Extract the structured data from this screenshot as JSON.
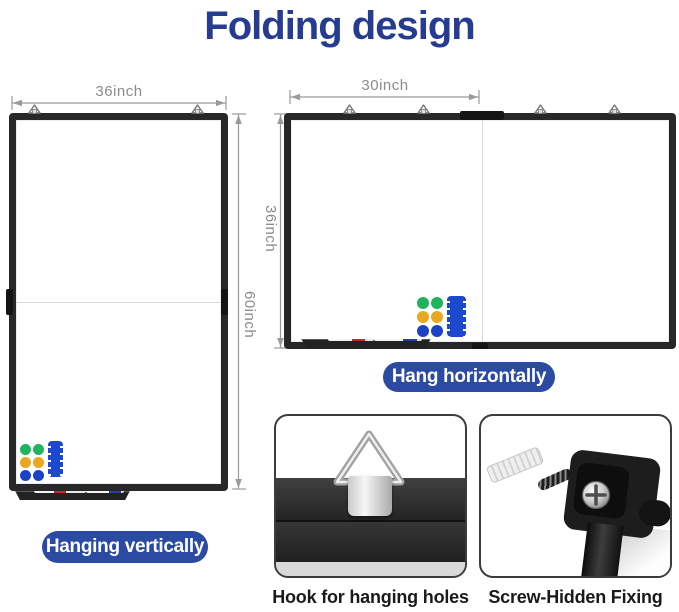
{
  "title": "Folding design",
  "boards": {
    "vertical": {
      "width_label": "36inch",
      "height_label": "60inch",
      "caption": "Hanging vertically"
    },
    "horizontal": {
      "width_label": "30inch",
      "height_label": "36inch",
      "caption": "Hang horizontally"
    }
  },
  "details": [
    {
      "caption": "Hook for hanging holes"
    },
    {
      "caption": "Screw-Hidden Fixing"
    }
  ],
  "icons": {
    "hanging_hook": "triangle-d-ring-hook",
    "magnets": "colored-dot-magnets",
    "eraser": "whiteboard-eraser",
    "markers": "marker-pens",
    "screw": "phillips-screw-head",
    "anchor": "wall-anchor-plug"
  },
  "colors": {
    "title": "#263c92",
    "pill_bg": "#2b4aa1",
    "pill_text": "#ffffff",
    "frame": "#282828",
    "dim_line": "#9a9a9a",
    "dim_text": "#8c8c8c",
    "fold_line": "#d9d9d9",
    "magnet_green": "#1eb35c",
    "magnet_yellow": "#e9a81f",
    "magnet_blue": "#1c41c4",
    "eraser_blue": "#1d49cf",
    "marker_red": "#c8252c",
    "marker_blue": "#27409b",
    "caption_text": "#1a1a1a"
  }
}
